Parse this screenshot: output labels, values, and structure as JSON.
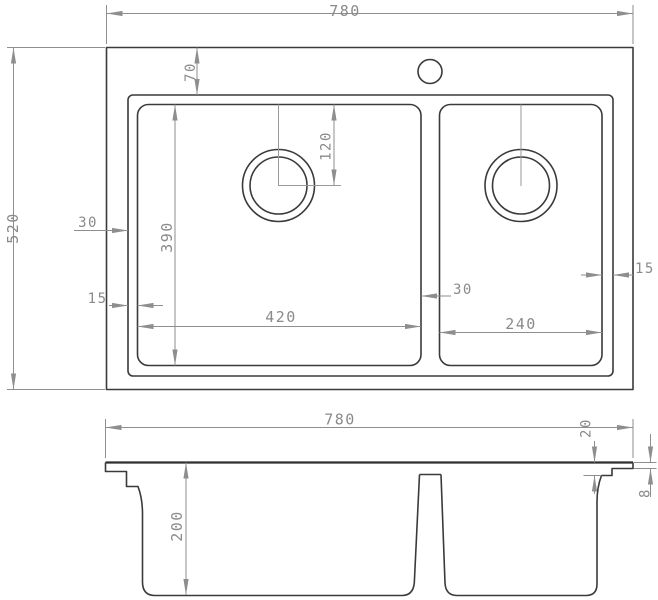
{
  "drawing": {
    "type": "technical-dimension-drawing",
    "subject": "double-bowl kitchen sink, top view and front section view",
    "top_view": {
      "overall_width": "780",
      "overall_depth": "520",
      "rim_offset_top": "70",
      "drain_offset_from_bowl_top": "120",
      "edge_to_rim_left": "30",
      "rim_to_bowl_left": "15",
      "bowl_front_to_back": "390",
      "left_bowl_width": "420",
      "gap_between_bowls": "30",
      "right_bowl_width": "240",
      "bowl_to_rim_right": "15"
    },
    "front_view": {
      "overall_width": "780",
      "rim_step_height": "20",
      "rim_sheet_thickness": "8",
      "bowl_depth": "200"
    },
    "colors": {
      "object_line": "#3a3a3a",
      "dimension_line": "#8e8e8e",
      "dimension_text": "#8a8a8a",
      "background": "#ffffff"
    }
  }
}
